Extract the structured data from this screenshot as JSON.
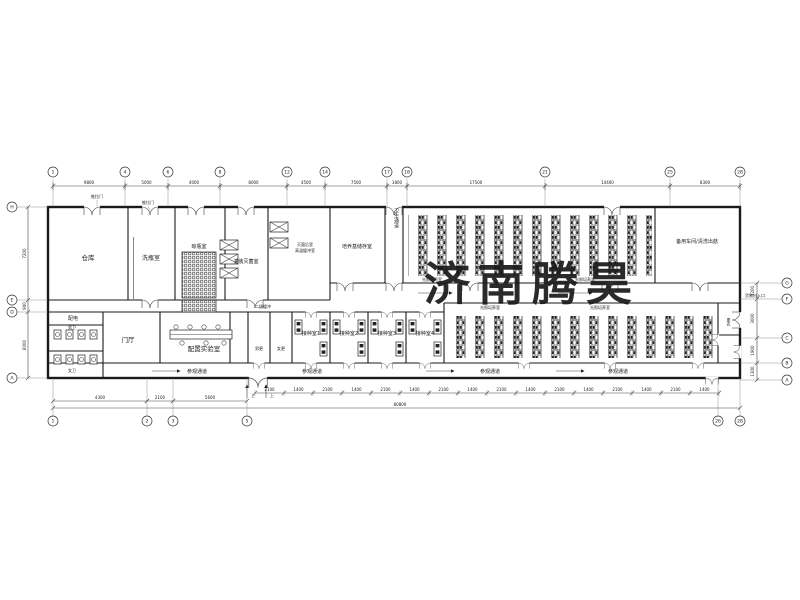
{
  "watermark": {
    "text": "济南腾昊",
    "color": "#e8251d"
  },
  "rooms": [
    {
      "name": "仓库"
    },
    {
      "name": "洗瓶室"
    },
    {
      "name": "晾瓶室"
    },
    {
      "name": "灌装灭菌室"
    },
    {
      "name": "灭菌后室"
    },
    {
      "name": "高温缓冲室"
    },
    {
      "name": "培养基储存室"
    },
    {
      "name": "卫生通道"
    },
    {
      "name": "光照培养室"
    },
    {
      "name": "光照培养室"
    },
    {
      "name": "备用车间/清洗出菇"
    },
    {
      "name": "配电"
    },
    {
      "name": "男卫"
    },
    {
      "name": "女卫"
    },
    {
      "name": "门厅"
    },
    {
      "name": "配置实验室"
    },
    {
      "name": "二级缓冲"
    },
    {
      "name": "男更"
    },
    {
      "name": "女更"
    },
    {
      "name": "接种室1"
    },
    {
      "name": "接种室2"
    },
    {
      "name": "接种室3"
    },
    {
      "name": "接种室4"
    },
    {
      "name": "光照培养室"
    },
    {
      "name": "光照培养室"
    },
    {
      "name": "更衣"
    },
    {
      "name": "参观通道"
    },
    {
      "name": "参观通道"
    },
    {
      "name": "参观通道"
    },
    {
      "name": "参观通道"
    }
  ],
  "annotations": {
    "sliding_door_1": "推拉门",
    "sliding_door_2": "推拉门",
    "cargo_entrance": "货物出入口",
    "up_1": "上",
    "up_2": "上"
  },
  "grid": {
    "top": {
      "labels": [
        "1",
        "4",
        "6",
        "8",
        "12",
        "14",
        "17",
        "18",
        "21",
        "25",
        "28"
      ],
      "x": [
        53,
        125,
        168,
        220,
        287,
        325,
        387,
        407,
        545,
        670,
        740
      ],
      "dims": [
        "9800",
        "5000",
        "4000",
        "8000",
        "4500",
        "7500",
        "1800",
        "17500",
        "14400",
        "8300"
      ]
    },
    "bottom": {
      "labels": [
        "1",
        "2",
        "3",
        "5",
        "26",
        "28"
      ],
      "x": [
        53,
        147,
        173,
        247,
        718,
        740
      ],
      "dims": [
        "4300",
        "2100",
        "5600"
      ],
      "repeat_dims": [
        "2100",
        "1400"
      ],
      "repeat_count": 16,
      "overall": "80800"
    },
    "left": {
      "labels": [
        "H",
        "E",
        "D",
        "A"
      ],
      "y": [
        207,
        300,
        312,
        378
      ],
      "dims": [
        "7200",
        "900",
        "6000"
      ]
    },
    "right": {
      "labels": [
        "G",
        "F",
        "C",
        "B",
        "A"
      ],
      "y": [
        283,
        299,
        338,
        363,
        380
      ],
      "dims": [
        "1200",
        "3000",
        "1900",
        "1300"
      ]
    }
  }
}
